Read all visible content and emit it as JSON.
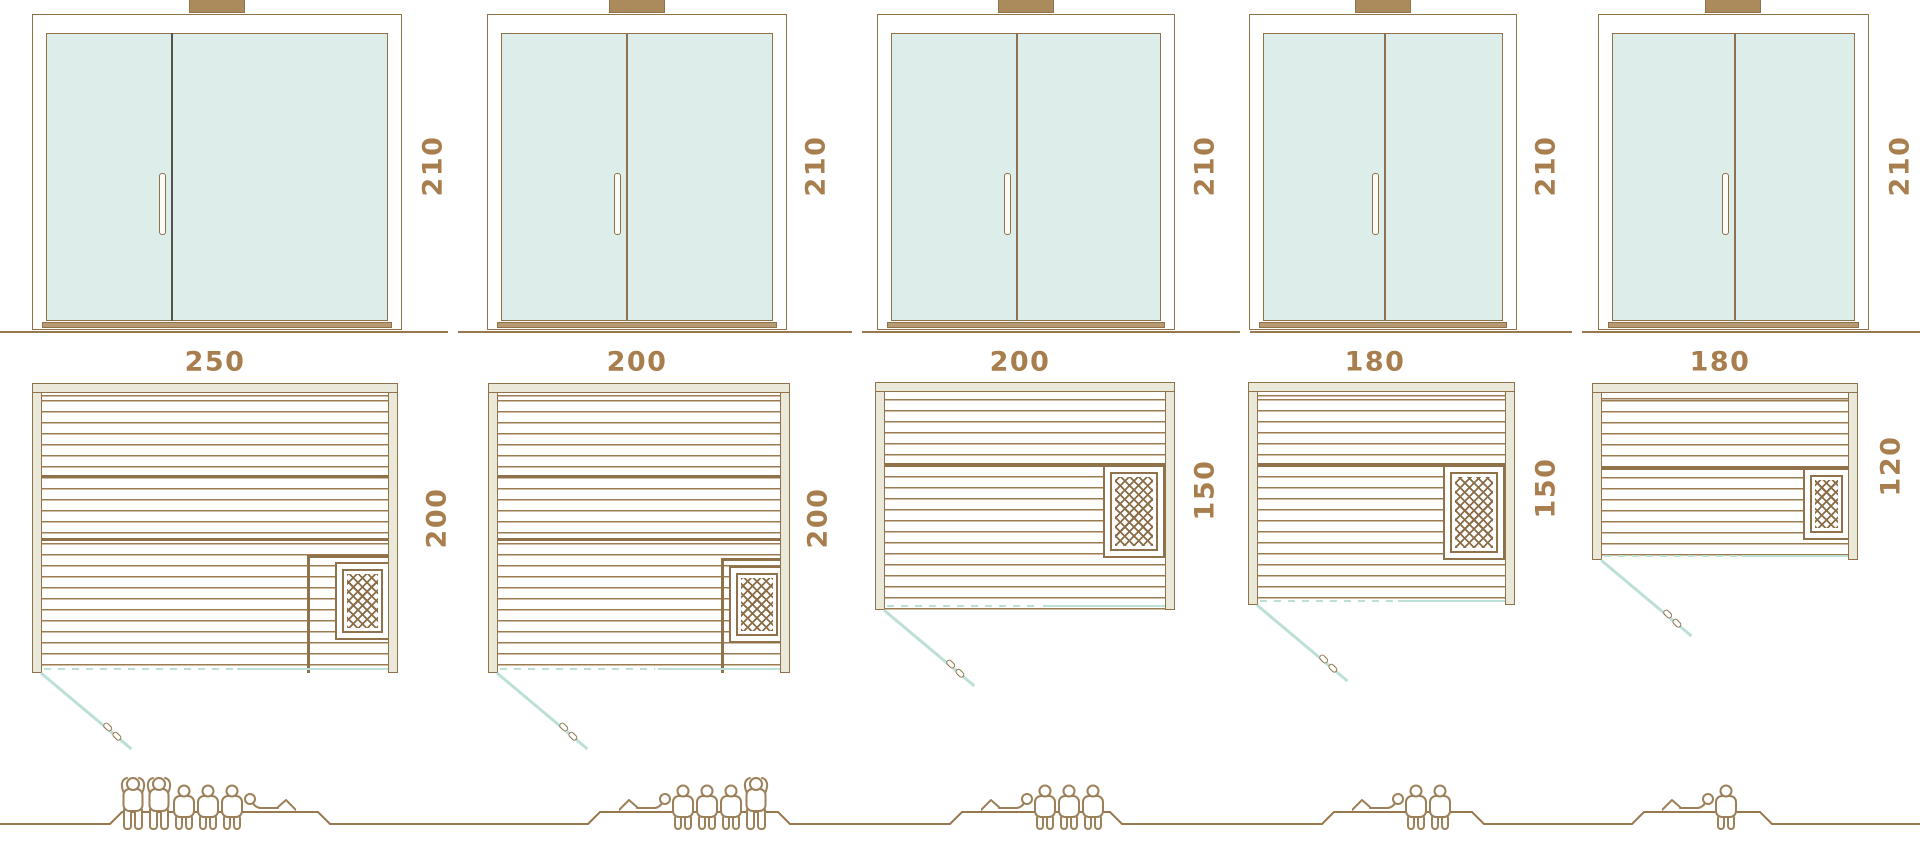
{
  "diagram_title": "Sauna size comparison",
  "units": [
    {
      "name": "sauna-250x200",
      "door": {
        "height_cm": "210"
      },
      "plan": {
        "width_cm": "250",
        "depth_cm": "200"
      },
      "capacity_people": 6,
      "figures": [
        "standing",
        "standing",
        "sitting",
        "sitting",
        "sitting",
        "lying_left"
      ]
    },
    {
      "name": "sauna-200x200",
      "door": {
        "height_cm": "210"
      },
      "plan": {
        "width_cm": "200",
        "depth_cm": "200"
      },
      "capacity_people": 5,
      "figures": [
        "lying_right",
        "sitting",
        "sitting",
        "sitting",
        "standing"
      ]
    },
    {
      "name": "sauna-200x150",
      "door": {
        "height_cm": "210"
      },
      "plan": {
        "width_cm": "200",
        "depth_cm": "150"
      },
      "capacity_people": 4,
      "figures": [
        "lying_right",
        "sitting",
        "sitting",
        "sitting"
      ]
    },
    {
      "name": "sauna-180x150",
      "door": {
        "height_cm": "210"
      },
      "plan": {
        "width_cm": "180",
        "depth_cm": "150"
      },
      "capacity_people": 3,
      "figures": [
        "lying_right",
        "sitting",
        "sitting"
      ]
    },
    {
      "name": "sauna-180x120",
      "door": {
        "height_cm": "210"
      },
      "plan": {
        "width_cm": "180",
        "depth_cm": "120"
      },
      "capacity_people": 2,
      "figures": [
        "lying_right",
        "sitting"
      ]
    }
  ],
  "icons": {
    "person_standing": "standing-person-outline",
    "person_sitting": "sitting-person-outline",
    "person_lying": "reclining-person-outline",
    "heater": "sauna-heater-crosshatch",
    "door_swing": "door-swing-arc-with-handle"
  },
  "colors": {
    "outline": "#8f7249",
    "dim_text": "#a87e4e",
    "glass": "#ddedea",
    "teal": "#bcdfd8",
    "wall_fill": "#eae8d9",
    "hatch": "#8a6c47",
    "slat": "#9c7b50",
    "people": "#9c8059"
  }
}
